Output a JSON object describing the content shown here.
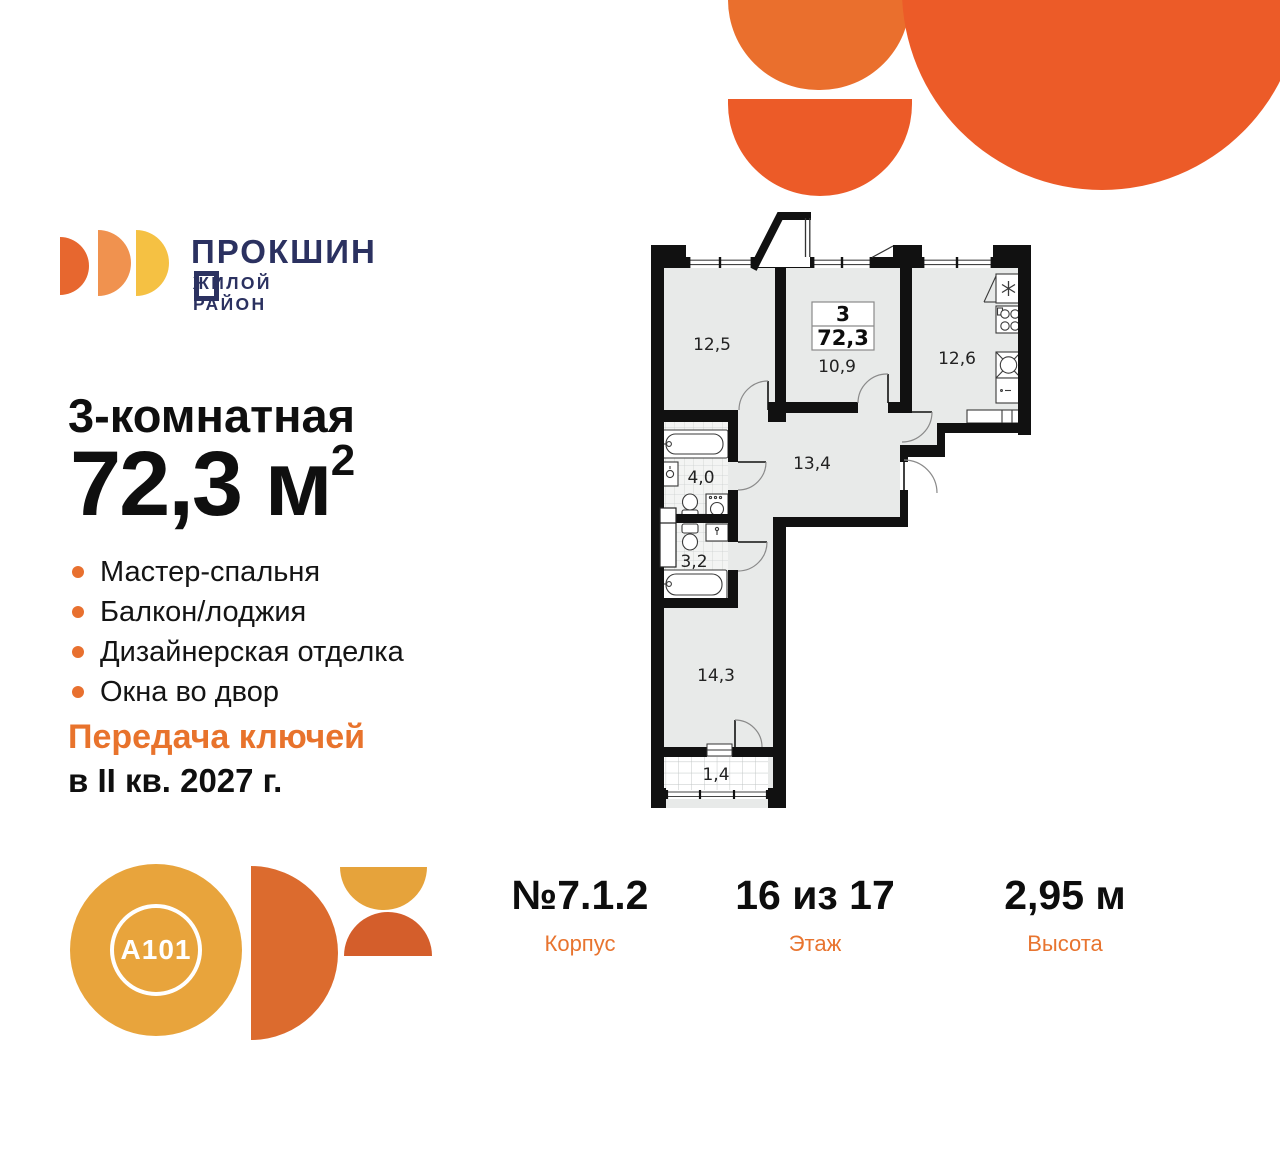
{
  "brand": {
    "wordmark": "ПРОКШИН",
    "wordmark_full": "ПРОКШИНО",
    "subtitle": "ЖИЛОЙ РАЙОН"
  },
  "listing": {
    "type": "3-комнатная",
    "area_value": "72,3",
    "area_unit": "м",
    "area_exp": "2",
    "features": [
      "Мастер-спальня",
      "Балкон/лоджия",
      "Дизайнерская отделка",
      "Окна во двор"
    ],
    "handover_title": "Передача ключей",
    "handover_term": "в II кв. 2027 г."
  },
  "plan": {
    "summary": {
      "rooms": "3",
      "area": "72,3"
    },
    "areas": {
      "living": "12,5",
      "bedroom": "10,9",
      "kitchen": "12,6",
      "hallway": "13,4",
      "bathroom": "4,0",
      "wc": "3,2",
      "master": "14,3",
      "balcony": "1,4"
    }
  },
  "footer": {
    "columns": [
      {
        "value": "№7.1.2",
        "label": "Корпус"
      },
      {
        "value": "16 из 17",
        "label": "Этаж"
      },
      {
        "value": "2,95 м",
        "label": "Высота"
      }
    ]
  },
  "partner_logo": {
    "text": "A101"
  },
  "colors": {
    "accent_orange": "#EC5B28",
    "light_orange": "#EA6F2D",
    "text_orange": "#E8742F",
    "navy": "#2B3160",
    "gold": "#E8A43C",
    "half_disc_orange": "#DC6B2E"
  }
}
